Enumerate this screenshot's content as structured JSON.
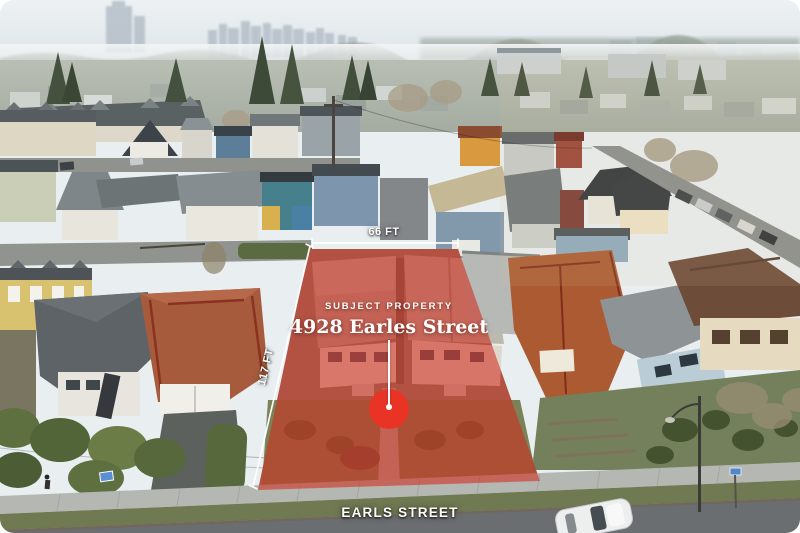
{
  "photo": {
    "description": "Aerial drone view of residential neighbourhood with highlighted subject parcel"
  },
  "annotations": {
    "frontage_label": "66 FT",
    "depth_label": "117 FT",
    "subject_property_eyebrow": "SUBJECT PROPERTY",
    "subject_property_address": "4928 Earles Street",
    "street_label": "EARLS STREET"
  },
  "colors": {
    "parcel_overlay": "#d2281a",
    "marker": "#e93425",
    "dimension_line": "#ffffff",
    "label_text": "#ffffff"
  }
}
